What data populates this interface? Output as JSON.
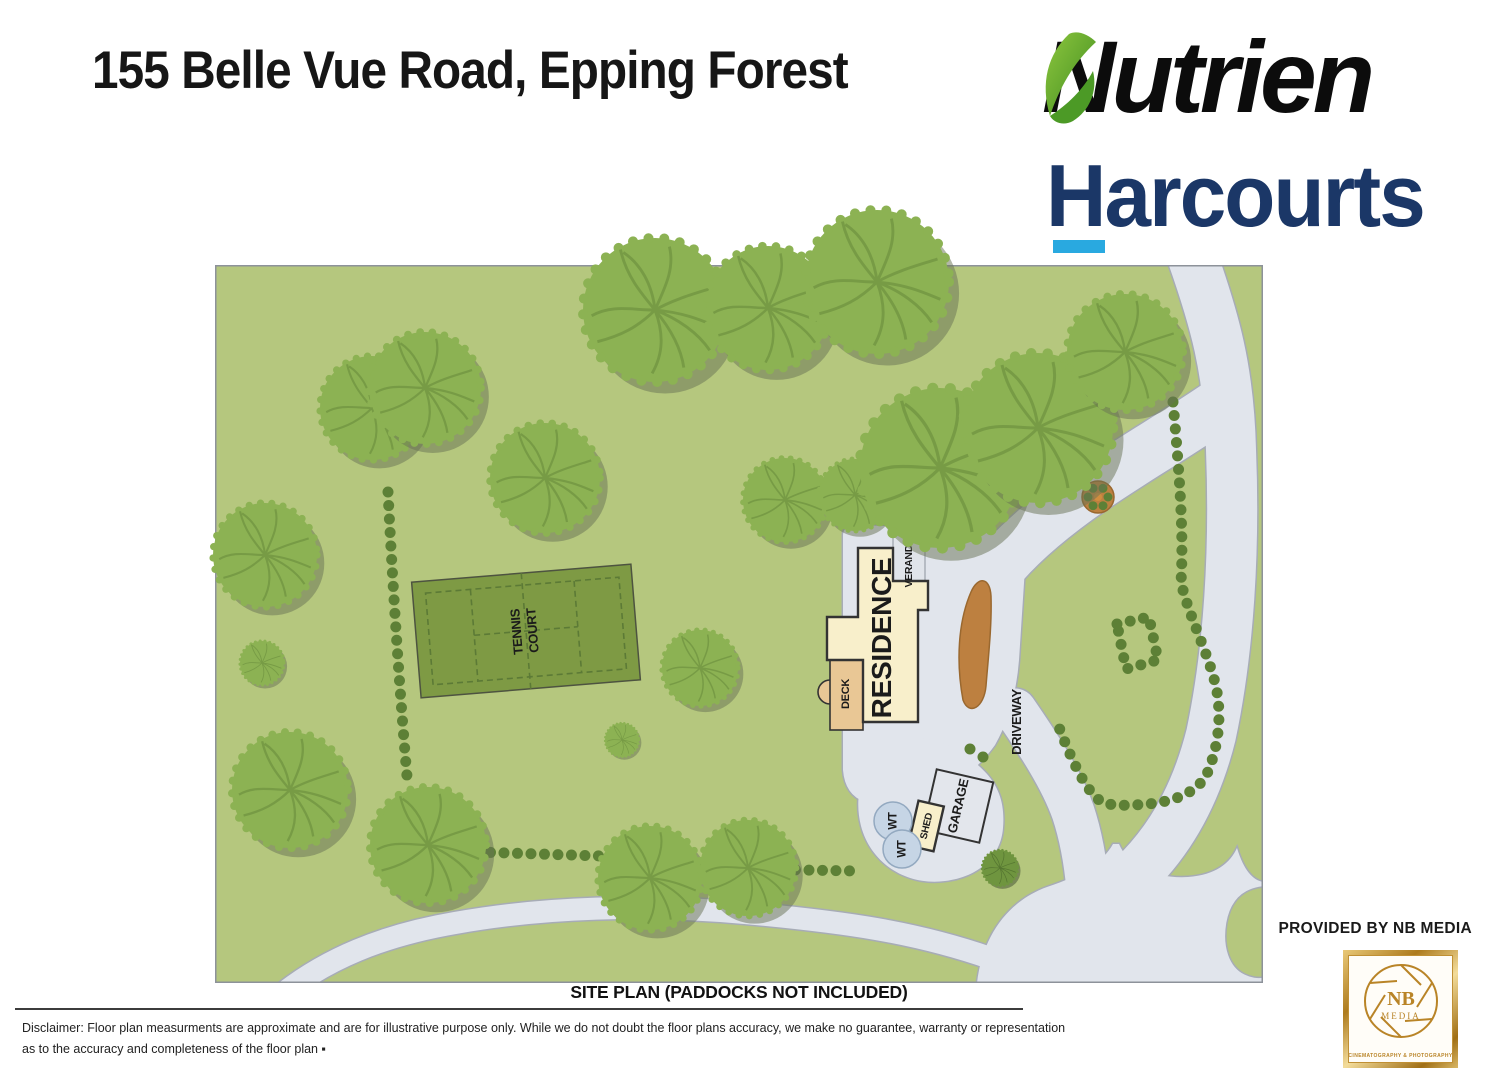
{
  "header": {
    "title": "155 Belle Vue Road, Epping Forest"
  },
  "brand": {
    "nutrien": "Nutrien",
    "harcourts": "Harcourts"
  },
  "map_labels": {
    "residence": "RESIDENCE",
    "verandah": "VERANDAH",
    "deck": "DECK",
    "tennis_line1": "TENNIS",
    "tennis_line2": "COURT",
    "garage": "GARAGE",
    "shed": "SHED",
    "wt": "WT",
    "driveway": "DRIVEWAY"
  },
  "caption": "SITE PLAN (PADDOCKS NOT INCLUDED)",
  "disclaimer": {
    "line1": "Disclaimer: Floor plan measurments are approximate and are for illustrative purpose only. While we do not doubt the floor plans accuracy, we make no guarantee, warranty or representation",
    "line2": "as to the accuracy and completeness of the floor plan ▪"
  },
  "credit": {
    "provided_by": "PROVIDED BY NB MEDIA",
    "logo_nb": "NB",
    "logo_media": "MEDIA",
    "logo_tagline": "CINEMATOGRAPHY & PHOTOGRAPHY"
  },
  "colors": {
    "grass": "#b5c77e",
    "road": "#e1e5ec",
    "road_edge": "#a7acb6",
    "tree": "#8cb253",
    "tree_vein": "#6e9140",
    "tree_shadow": "rgba(104,114,84,0.5)",
    "bush": "#5d8036",
    "court": "#7e9a44",
    "court_line": "#5c7a36",
    "cream": "#f8efcb",
    "tan": "#e9c795",
    "brown": "#bd8040",
    "wt": "#c6d5e5",
    "outline": "#333333",
    "navy": "#1b3767",
    "light_blue": "#29a9e0",
    "gold": "#b98427",
    "ink": "#161616"
  }
}
